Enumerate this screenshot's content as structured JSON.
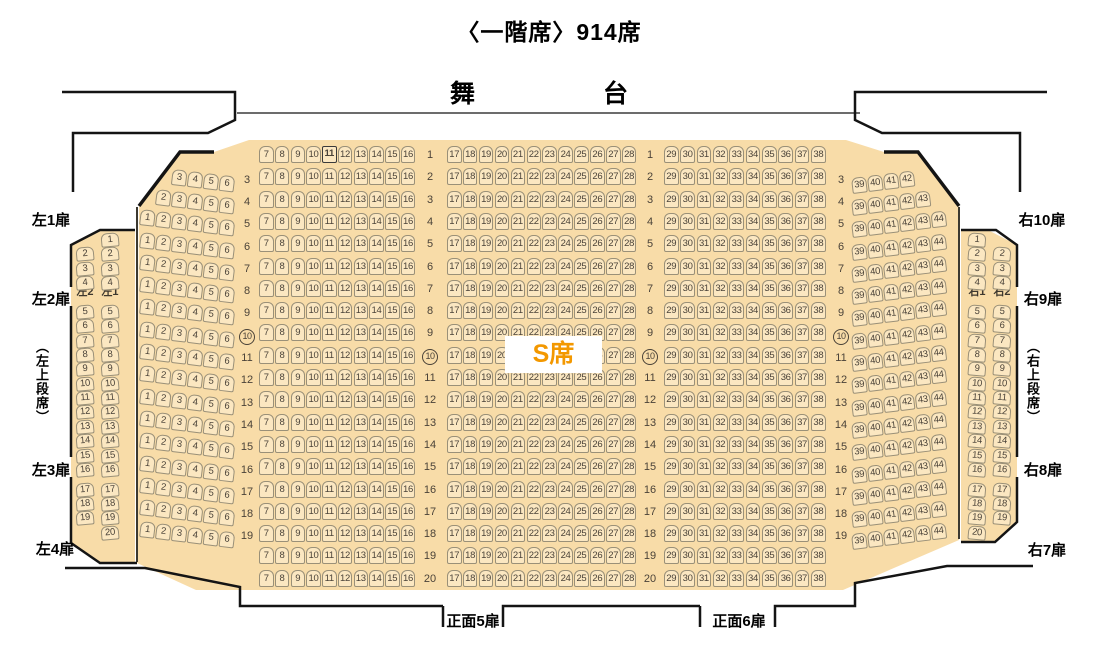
{
  "title": "〈一階席〉914席",
  "stage_label": "舞台",
  "s_class_label": "S席",
  "doors": {
    "left": [
      "左1扉",
      "左2扉",
      "左3扉",
      "左4扉"
    ],
    "left_upper_tier": "（左上段席）",
    "right": [
      "右10扉",
      "右9扉",
      "右8扉",
      "右7扉"
    ],
    "right_upper_tier": "（右上段席）",
    "front": [
      "正面5扉",
      "正面6扉"
    ]
  },
  "seat_map": {
    "center_blocks": [
      {
        "name": "center-left",
        "seats": [
          7,
          16
        ],
        "rows": [
          1,
          20
        ]
      },
      {
        "name": "center",
        "seats": [
          17,
          28
        ],
        "rows": [
          1,
          20
        ]
      },
      {
        "name": "center-right",
        "seats": [
          29,
          38
        ],
        "rows": [
          1,
          20
        ]
      }
    ],
    "slant_left": [
      {
        "rows": [
          3,
          3
        ],
        "seats": [
          3,
          6
        ]
      },
      {
        "rows": [
          4,
          4
        ],
        "seats": [
          2,
          6
        ]
      },
      {
        "rows": [
          5,
          19
        ],
        "seats": [
          1,
          6
        ]
      }
    ],
    "slant_right": [
      {
        "rows": [
          3,
          3
        ],
        "seats": [
          39,
          42
        ]
      },
      {
        "rows": [
          4,
          4
        ],
        "seats": [
          39,
          43
        ]
      },
      {
        "rows": [
          5,
          19
        ],
        "seats": [
          39,
          44
        ]
      }
    ],
    "side_left": {
      "columns": [
        {
          "label": "左2",
          "seats": [
            2,
            3,
            4,
            5,
            6,
            7,
            8,
            9,
            10,
            11,
            12,
            13,
            14,
            15,
            16,
            17,
            18,
            19
          ]
        },
        {
          "label": "左1",
          "seats": [
            1,
            2,
            3,
            4,
            5,
            6,
            7,
            8,
            9,
            10,
            11,
            12,
            13,
            14,
            15,
            16,
            17,
            18,
            19,
            20
          ]
        }
      ]
    },
    "side_right": {
      "columns": [
        {
          "label": "右1",
          "seats": [
            1,
            2,
            3,
            4,
            5,
            6,
            7,
            8,
            9,
            10,
            11,
            12,
            13,
            14,
            15,
            16,
            17,
            18,
            19,
            20
          ]
        },
        {
          "label": "右2",
          "seats": [
            2,
            3,
            4,
            5,
            6,
            7,
            8,
            9,
            10,
            11,
            12,
            13,
            14,
            15,
            16,
            17,
            18,
            19
          ]
        }
      ]
    },
    "row_label_columns": [
      {
        "id": "A",
        "rows": [
          3,
          19
        ]
      },
      {
        "id": "B",
        "rows": [
          1,
          20
        ]
      },
      {
        "id": "C",
        "rows": [
          1,
          20
        ]
      },
      {
        "id": "D",
        "rows": [
          3,
          19
        ]
      }
    ],
    "circled_row": 10,
    "special_seat": {
      "block": "center-left",
      "row": 1,
      "seat": 11
    }
  },
  "colors": {
    "floor": "#F8DCA8",
    "seat_fill": "#FBE7C1",
    "seat_border": "#9A9078",
    "seat_text": "#4A4238",
    "wall": "#141414",
    "s_class_accent": "#F39800"
  }
}
